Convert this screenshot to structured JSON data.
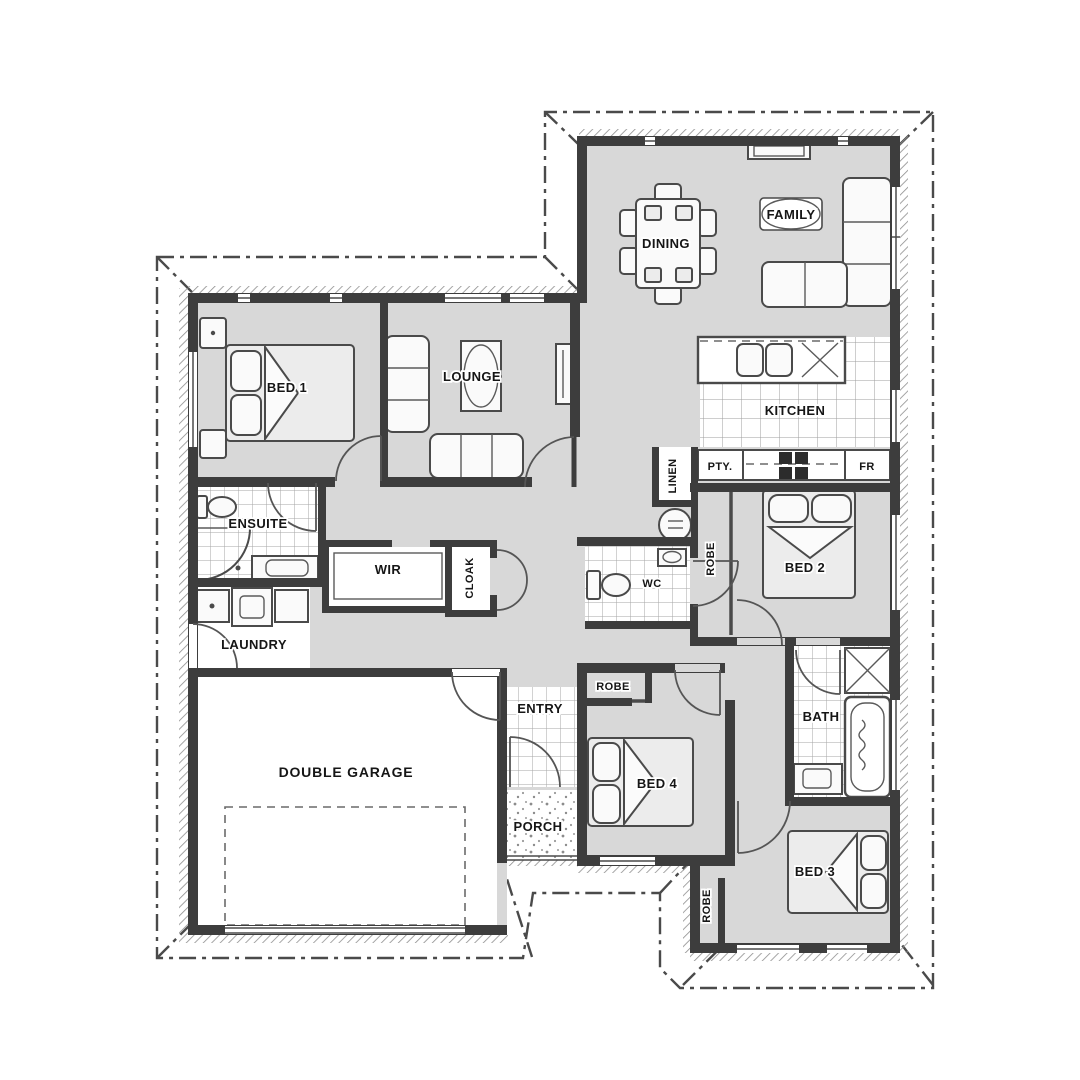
{
  "plan": {
    "type": "residential floor plan",
    "labels": {
      "bed1": "BED 1",
      "lounge": "LOUNGE",
      "dining": "DINING",
      "family": "FAMILY",
      "kitchen": "KITCHEN",
      "pantry": "PTY.",
      "fridge": "FR",
      "linen": "LINEN",
      "robe_bed2": "ROBE",
      "bed2": "BED 2",
      "wc": "WC",
      "cloak": "CLOAK",
      "wir": "WIR",
      "ensuite": "ENSUITE",
      "laundry": "LAUNDRY",
      "garage": "DOUBLE GARAGE",
      "entry": "ENTRY",
      "porch": "PORCH",
      "robe_bed4": "ROBE",
      "bed4": "BED 4",
      "bath": "BATH",
      "bed3": "BED 3",
      "robe_bed3": "ROBE"
    },
    "colors": {
      "background": "#ffffff",
      "room_fill": "#d8d8d8",
      "wall": "#3d3d3d",
      "line": "#4a4a4a",
      "tile_line": "#a5a5a5"
    }
  }
}
